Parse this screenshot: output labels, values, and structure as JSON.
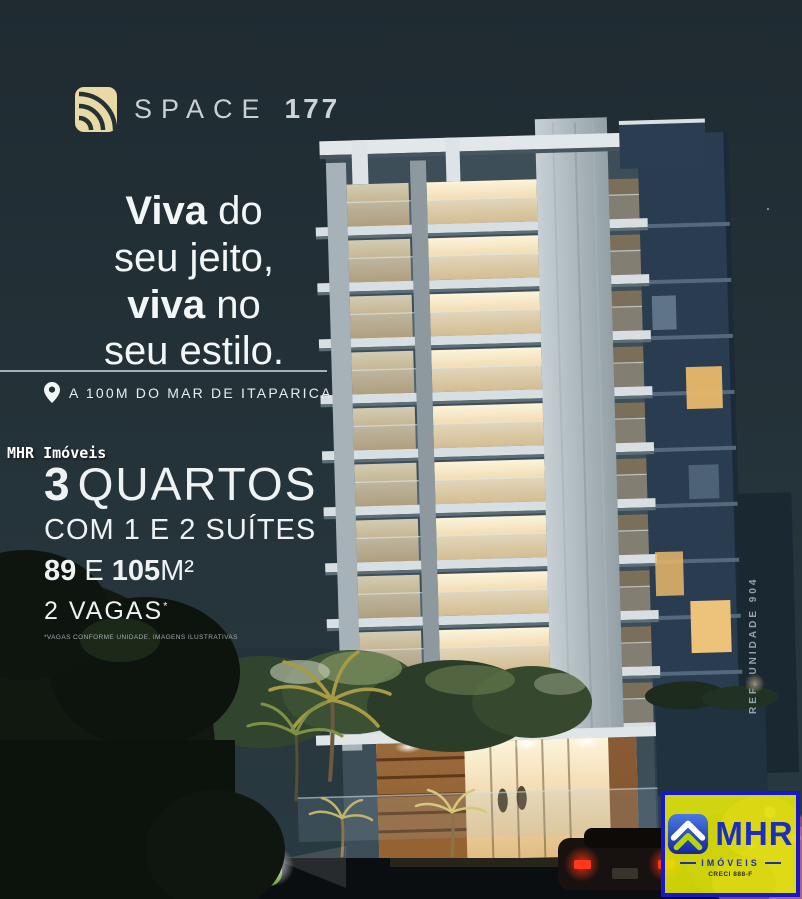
{
  "colors": {
    "background": "#233138",
    "logo_gold": "#e9d9a4",
    "logo_silver": "#c9cfd5",
    "headline_white": "#f3f6f6",
    "badge_yellow": "#e6eb08",
    "badge_blue": "#1717cd",
    "warm_window": "#f2e0b2"
  },
  "logo": {
    "name": "SPACE",
    "number": "177"
  },
  "headline": {
    "l1_bold": "Viva",
    "l1_rest": " do",
    "l2": "seu jeito,",
    "l3_bold": "viva",
    "l3_rest": " no",
    "l4": "seu estilo."
  },
  "location": {
    "text": "A 100M DO MAR DE ITAPARICA"
  },
  "watermark": {
    "text": "MHR Imóveis"
  },
  "specs": {
    "rooms_num": "3",
    "rooms_label": "QUARTOS",
    "suites": "COM 1 E 2 SUÍTES",
    "area_n1": "89",
    "area_mid": " E ",
    "area_n2": "105",
    "area_unit": "M²",
    "parking": "2 VAGAS",
    "parking_mark": "*",
    "fine_print": "*VAGAS CONFORME UNIDADE. IMAGENS ILUSTRATIVAS"
  },
  "reference": {
    "text": "REF. UNIDADE 904"
  },
  "badge": {
    "brand": "MHR",
    "subtitle": "IMÓVEIS",
    "creci": "CRECI 888-F"
  }
}
